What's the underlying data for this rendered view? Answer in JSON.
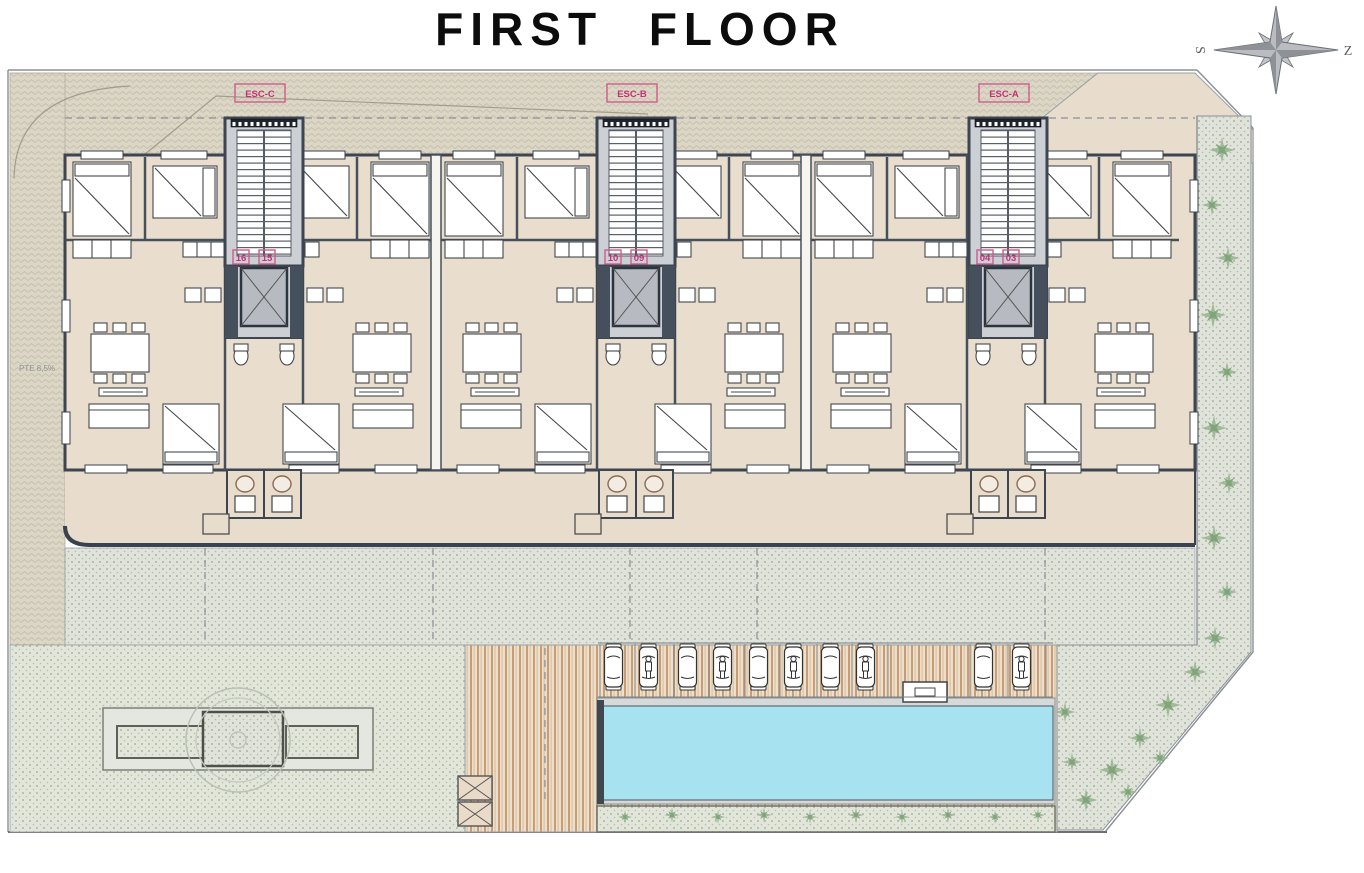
{
  "title": "FIRST FLOOR",
  "compass": {
    "west_label": "S",
    "east_label": "Z"
  },
  "plan": {
    "ramp_label": "PTE 8,5%",
    "cores": [
      {
        "label": "ESC-C",
        "units": [
          {
            "label": "16"
          },
          {
            "label": "15"
          }
        ]
      },
      {
        "label": "ESC-B",
        "units": [
          {
            "label": "10"
          },
          {
            "label": "09"
          }
        ]
      },
      {
        "label": "ESC-A",
        "units": [
          {
            "label": "04"
          },
          {
            "label": "03"
          }
        ]
      }
    ],
    "colors": {
      "accent_pink": "#c92f77",
      "pool_water": "#a6e2ef",
      "wall": "#46505c",
      "floor": "#e9ddcd"
    }
  }
}
